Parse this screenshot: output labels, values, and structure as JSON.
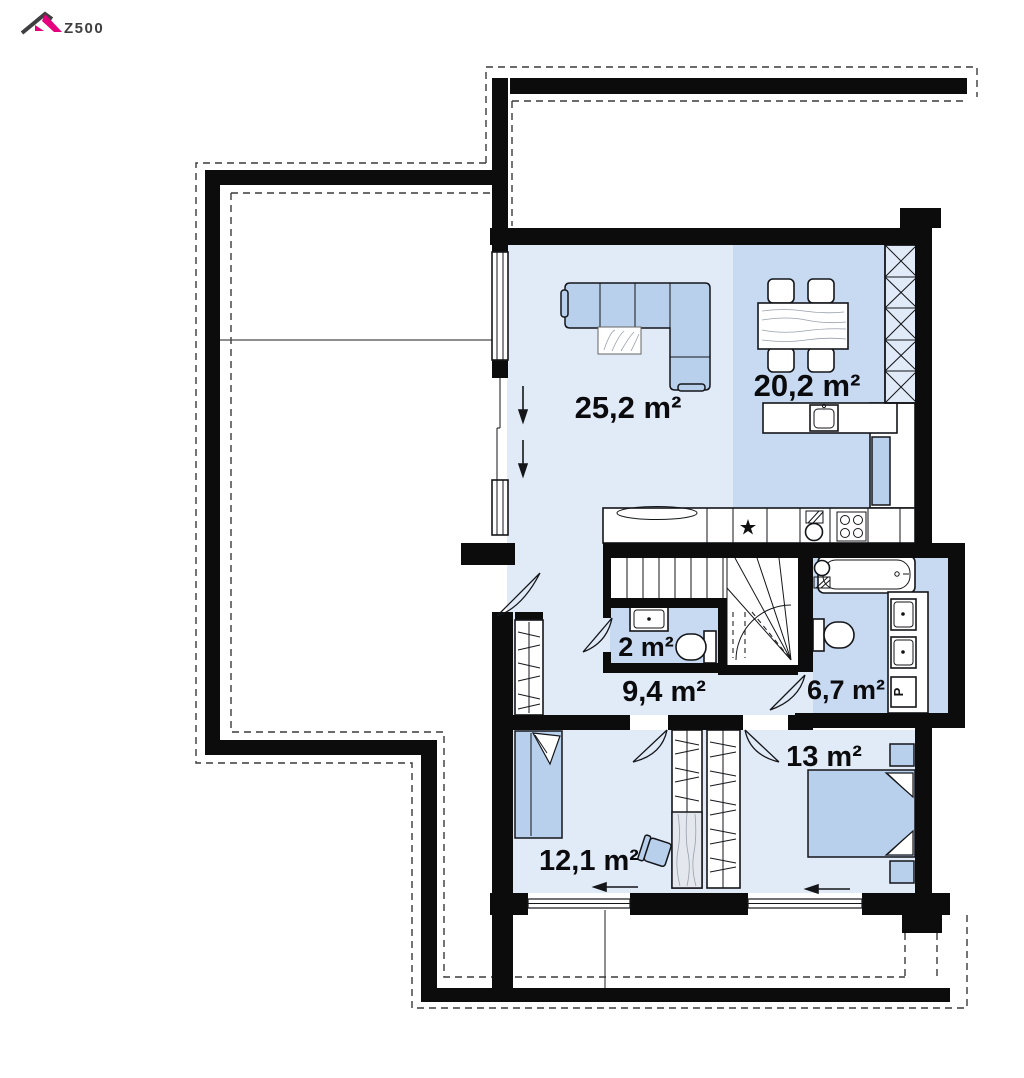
{
  "logo": {
    "brand": "Z500"
  },
  "rooms": {
    "living": {
      "label": "25,2 m²"
    },
    "dining": {
      "label": "20,2 m²"
    },
    "wc": {
      "label": "2 m²"
    },
    "hall": {
      "label": "9,4 m²"
    },
    "bathroom": {
      "label": "6,7 m²"
    },
    "bedroom_right": {
      "label": "13 m²"
    },
    "bedroom_left": {
      "label": "12,1 m²"
    }
  },
  "appliances": {
    "washing_machine": "P"
  },
  "colors": {
    "wall": "#0c0c0c",
    "floor_light": "#e1eaf7",
    "floor_medium": "#c7daf2",
    "furniture": "#b9d0ec",
    "logo_pink": "#e5007d",
    "logo_text": "#3f3f41"
  }
}
